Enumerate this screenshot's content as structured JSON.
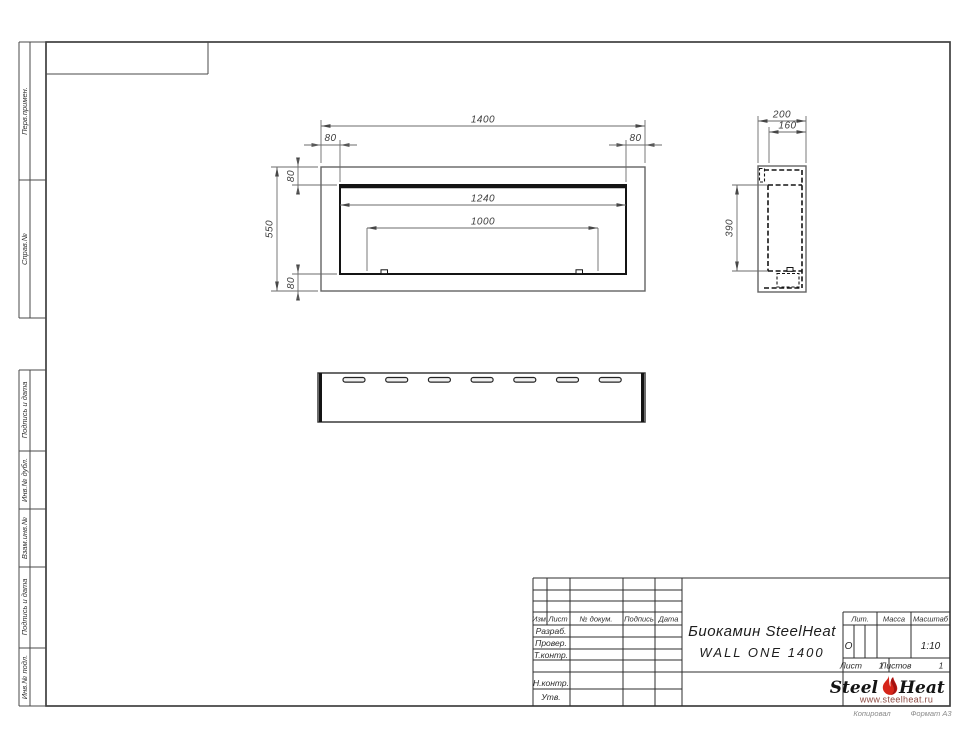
{
  "sheet": {
    "copied_label": "Копировал",
    "format_label": "Формат А3"
  },
  "margin_columns": {
    "col1": "Перв.примен.",
    "col2": "Справ.№",
    "col3": "Подпись и дата",
    "col4": "Инв.№ дубл.",
    "col5": "Взам.инв.№",
    "col6": "Подпись и дата",
    "col7": "Инв.№ подл."
  },
  "title_block": {
    "rev_header": {
      "izm": "Изм.",
      "list": "Лист",
      "doc": "№ докум.",
      "sign": "Подпись",
      "date": "Дата"
    },
    "roles": {
      "developed": "Разраб.",
      "checked": "Провер.",
      "tcontrol": "Т.контр.",
      "ncontrol": "Н.контр.",
      "approved": "Утв."
    },
    "title_line1": "Биокамин SteelHeat",
    "title_line2": "WALL ONE 1400",
    "lit_label": "Лит.",
    "lit_value": "О",
    "mass_label": "Масса",
    "scale_label": "Масштаб",
    "scale_value": "1:10",
    "sheet_label": "Лист",
    "sheet_value": "1",
    "sheets_label": "Листов",
    "sheets_value": "1"
  },
  "logo": {
    "word1": "Steel",
    "word2": "Heat",
    "website": "www.steelheat.ru",
    "flame_color": "#d6251a"
  },
  "drawing": {
    "front": {
      "width": "1400",
      "height": "550",
      "inner_width": "1240",
      "burner_width": "1000",
      "margin_left": "80",
      "margin_right": "80",
      "margin_top": "80",
      "margin_bottom": "80"
    },
    "side": {
      "depth": "200",
      "inner_depth": "160",
      "inner_height": "390"
    }
  }
}
